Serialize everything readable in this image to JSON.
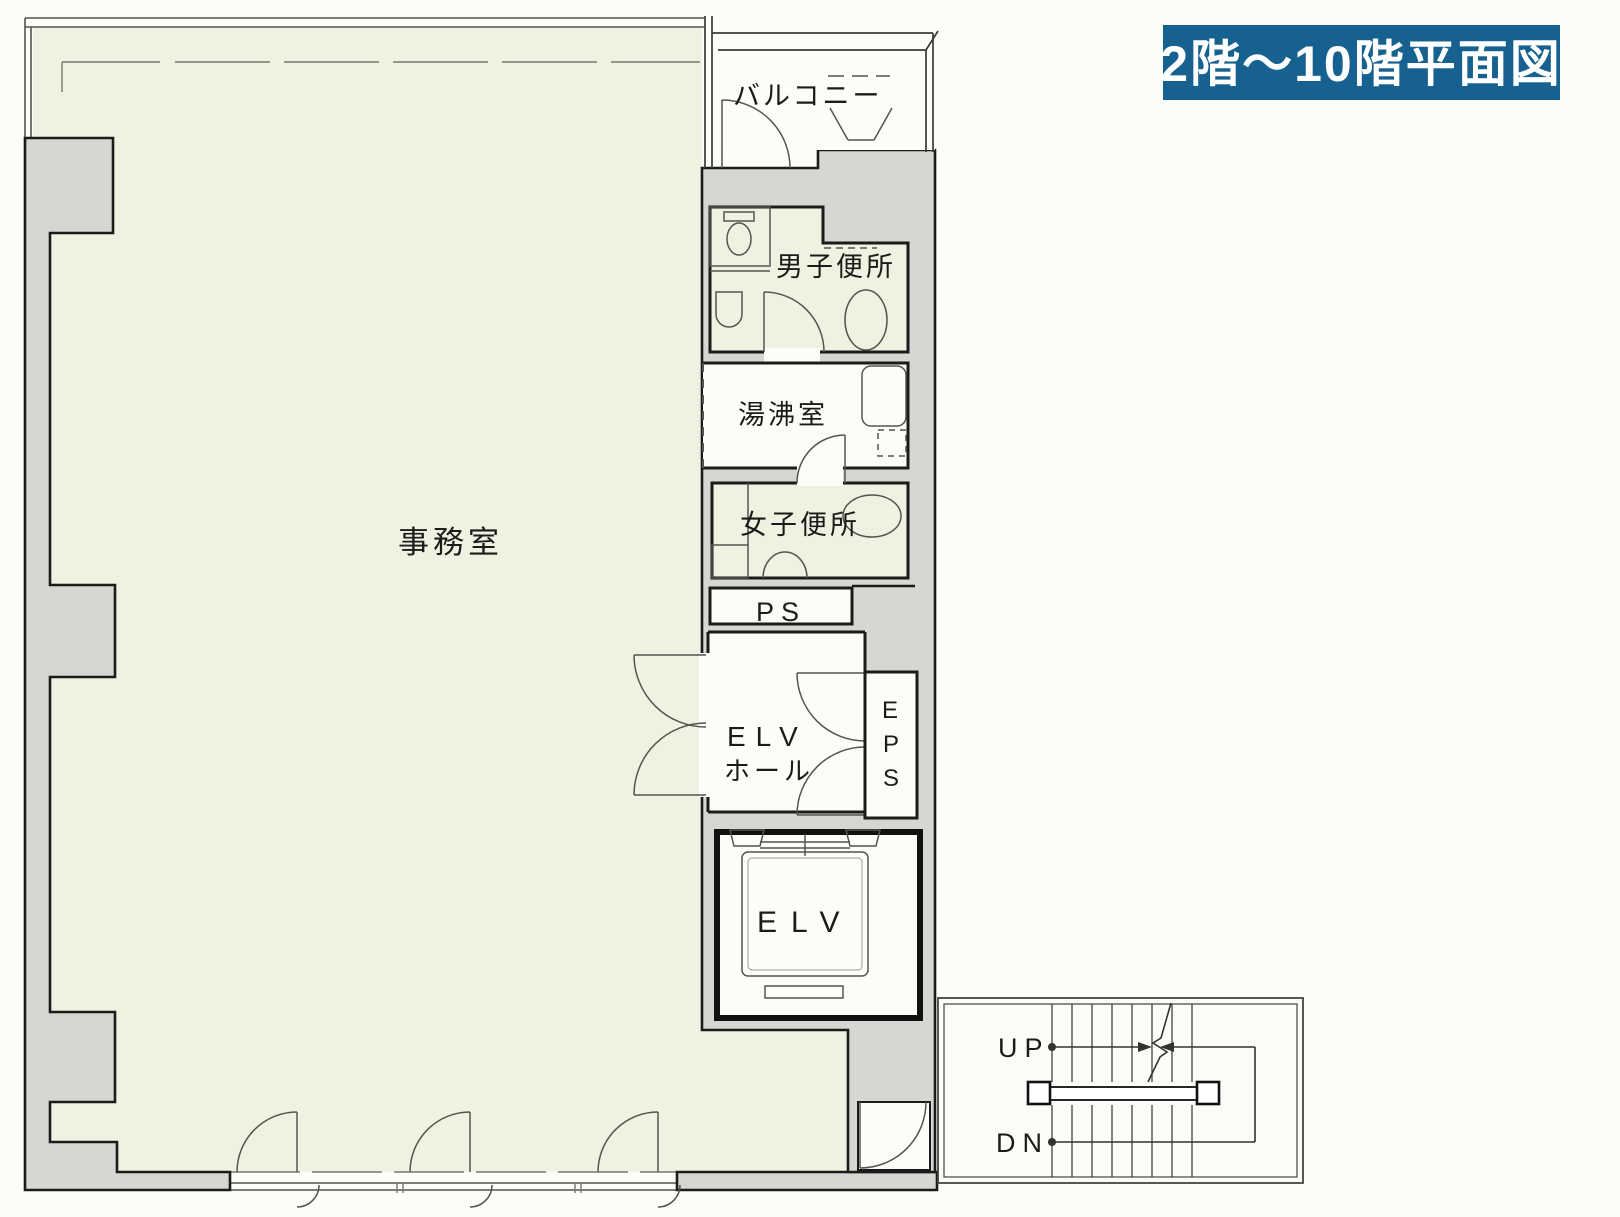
{
  "title": {
    "text": "2階〜10階平面図"
  },
  "rooms": {
    "office": {
      "label": "事務室"
    },
    "balcony": {
      "label": "バルコニー"
    },
    "mens_toilet": {
      "label": "男子便所"
    },
    "kitchenette": {
      "label": "湯沸室"
    },
    "womens_toilet": {
      "label": "女子便所"
    },
    "pipe_space": {
      "label": "PS"
    },
    "elevator_hall": {
      "label_line1": "ELV",
      "label_line2": "ホール"
    },
    "eps": {
      "letters": [
        "E",
        "P",
        "S"
      ]
    },
    "elevator": {
      "label": "ELV"
    },
    "stairs": {
      "up": "UP",
      "down": "DN"
    }
  },
  "colors": {
    "badge_bg": "#16618f",
    "badge_text": "#ffffff",
    "room_fill": "#edf3e0",
    "wall_fill": "#d6d6d3",
    "outline": "#1b1b1b",
    "paper": "#fcfcf8"
  }
}
